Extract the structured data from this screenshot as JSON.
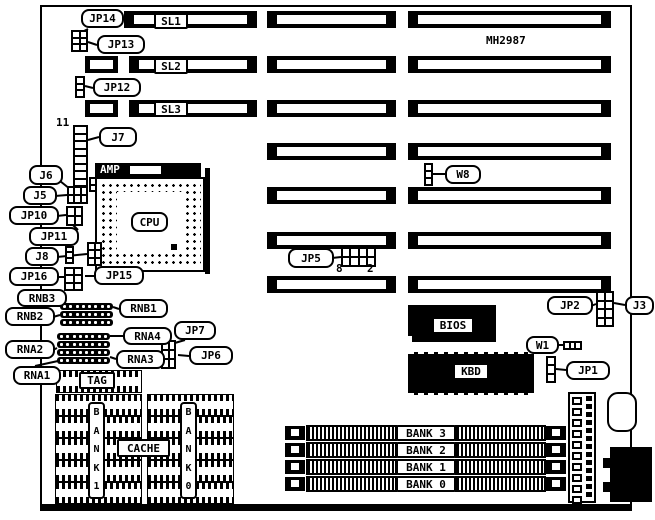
{
  "diagram_title": "MH2987",
  "board": {
    "part_number": "MH2987"
  },
  "cpu": {
    "socket_brand": "AMP",
    "chip_label": "CPU"
  },
  "texts": [
    {
      "name": "board-part-number",
      "text": "MH2987",
      "x": 486,
      "y": 34
    },
    {
      "name": "j7-pin-11",
      "text": "11",
      "x": 56,
      "y": 116
    },
    {
      "name": "jp5-pin-8",
      "text": "8",
      "x": 336,
      "y": 262
    },
    {
      "name": "jp5-pin-2",
      "text": "2",
      "x": 367,
      "y": 262
    }
  ],
  "callouts": [
    {
      "name": "label-jp14",
      "text": "JP14",
      "x": 81,
      "y": 9,
      "w": 43,
      "h": 19,
      "kind": "round"
    },
    {
      "name": "label-sl1",
      "text": "SL1",
      "x": 154,
      "y": 13,
      "w": 34,
      "h": 16,
      "kind": "square"
    },
    {
      "name": "label-jp13",
      "text": "JP13",
      "x": 97,
      "y": 35,
      "w": 48,
      "h": 19,
      "kind": "round"
    },
    {
      "name": "label-sl2",
      "text": "SL2",
      "x": 154,
      "y": 58,
      "w": 34,
      "h": 16,
      "kind": "square"
    },
    {
      "name": "label-jp12",
      "text": "JP12",
      "x": 93,
      "y": 78,
      "w": 48,
      "h": 19,
      "kind": "round"
    },
    {
      "name": "label-sl3",
      "text": "SL3",
      "x": 154,
      "y": 101,
      "w": 34,
      "h": 16,
      "kind": "square"
    },
    {
      "name": "label-j7",
      "text": "J7",
      "x": 99,
      "y": 127,
      "w": 38,
      "h": 20,
      "kind": "round"
    },
    {
      "name": "label-j6",
      "text": "J6",
      "x": 29,
      "y": 165,
      "w": 34,
      "h": 20,
      "kind": "round"
    },
    {
      "name": "label-j5",
      "text": "J5",
      "x": 23,
      "y": 186,
      "w": 34,
      "h": 19,
      "kind": "round"
    },
    {
      "name": "label-jp10",
      "text": "JP10",
      "x": 9,
      "y": 206,
      "w": 50,
      "h": 19,
      "kind": "round"
    },
    {
      "name": "label-jp11",
      "text": "JP11",
      "x": 29,
      "y": 227,
      "w": 50,
      "h": 19,
      "kind": "round"
    },
    {
      "name": "label-j8",
      "text": "J8",
      "x": 25,
      "y": 247,
      "w": 34,
      "h": 19,
      "kind": "round"
    },
    {
      "name": "label-jp16",
      "text": "JP16",
      "x": 9,
      "y": 267,
      "w": 50,
      "h": 19,
      "kind": "round"
    },
    {
      "name": "label-jp15",
      "text": "JP15",
      "x": 94,
      "y": 266,
      "w": 50,
      "h": 19,
      "kind": "round"
    },
    {
      "name": "label-rnb3",
      "text": "RNB3",
      "x": 17,
      "y": 289,
      "w": 50,
      "h": 18,
      "kind": "round"
    },
    {
      "name": "label-rnb1",
      "text": "RNB1",
      "x": 119,
      "y": 299,
      "w": 49,
      "h": 19,
      "kind": "round"
    },
    {
      "name": "label-rnb2",
      "text": "RNB2",
      "x": 5,
      "y": 307,
      "w": 50,
      "h": 19,
      "kind": "round"
    },
    {
      "name": "label-rna4",
      "text": "RNA4",
      "x": 123,
      "y": 327,
      "w": 49,
      "h": 18,
      "kind": "round"
    },
    {
      "name": "label-jp7",
      "text": "JP7",
      "x": 174,
      "y": 321,
      "w": 42,
      "h": 19,
      "kind": "round"
    },
    {
      "name": "label-rna2",
      "text": "RNA2",
      "x": 5,
      "y": 340,
      "w": 50,
      "h": 19,
      "kind": "round"
    },
    {
      "name": "label-rna3",
      "text": "RNA3",
      "x": 116,
      "y": 350,
      "w": 49,
      "h": 19,
      "kind": "round"
    },
    {
      "name": "label-jp6",
      "text": "JP6",
      "x": 189,
      "y": 346,
      "w": 44,
      "h": 19,
      "kind": "round"
    },
    {
      "name": "label-rna1",
      "text": "RNA1",
      "x": 13,
      "y": 366,
      "w": 48,
      "h": 19,
      "kind": "round"
    },
    {
      "name": "label-tag",
      "text": "TAG",
      "x": 79,
      "y": 372,
      "w": 36,
      "h": 17,
      "kind": "square"
    },
    {
      "name": "label-cpu",
      "text": "CPU",
      "x": 131,
      "y": 212,
      "w": 37,
      "h": 20,
      "kind": "round"
    },
    {
      "name": "label-cache",
      "text": "CACHE",
      "x": 117,
      "y": 439,
      "w": 53,
      "h": 18,
      "kind": "square"
    },
    {
      "name": "label-jp5",
      "text": "JP5",
      "x": 288,
      "y": 248,
      "w": 46,
      "h": 20,
      "kind": "round"
    },
    {
      "name": "label-w8",
      "text": "W8",
      "x": 445,
      "y": 165,
      "w": 36,
      "h": 19,
      "kind": "round"
    },
    {
      "name": "label-bios",
      "text": "BIOS",
      "x": 432,
      "y": 317,
      "w": 42,
      "h": 17,
      "kind": "square"
    },
    {
      "name": "label-kbd",
      "text": "KBD",
      "x": 453,
      "y": 363,
      "w": 36,
      "h": 17,
      "kind": "square"
    },
    {
      "name": "label-jp2",
      "text": "JP2",
      "x": 547,
      "y": 296,
      "w": 46,
      "h": 19,
      "kind": "round"
    },
    {
      "name": "label-j3",
      "text": "J3",
      "x": 625,
      "y": 296,
      "w": 29,
      "h": 19,
      "kind": "round"
    },
    {
      "name": "label-w1",
      "text": "W1",
      "x": 526,
      "y": 336,
      "w": 33,
      "h": 18,
      "kind": "round"
    },
    {
      "name": "label-jp1",
      "text": "JP1",
      "x": 566,
      "y": 361,
      "w": 44,
      "h": 19,
      "kind": "round"
    },
    {
      "name": "label-simm-bank3",
      "text": "BANK 3",
      "x": 396,
      "y": 425,
      "w": 60,
      "h": 16,
      "kind": "square"
    },
    {
      "name": "label-simm-bank2",
      "text": "BANK 2",
      "x": 396,
      "y": 442,
      "w": 60,
      "h": 16,
      "kind": "square"
    },
    {
      "name": "label-simm-bank1",
      "text": "BANK 1",
      "x": 396,
      "y": 459,
      "w": 60,
      "h": 16,
      "kind": "square"
    },
    {
      "name": "label-simm-bank0",
      "text": "BANK 0",
      "x": 396,
      "y": 476,
      "w": 60,
      "h": 16,
      "kind": "square"
    }
  ],
  "vertical_labels": [
    {
      "name": "label-cache-bank1",
      "text": "BANK1",
      "x": 88,
      "y": 402,
      "w": 17,
      "h": 97
    },
    {
      "name": "label-cache-bank0",
      "text": "BANK0",
      "x": 180,
      "y": 402,
      "w": 17,
      "h": 97
    }
  ],
  "slot_rows": [
    {
      "y": 11,
      "h": 17,
      "segments": [
        {
          "x": 124,
          "w": 133
        },
        {
          "x": 267,
          "w": 129
        },
        {
          "x": 408,
          "w": 203
        }
      ]
    },
    {
      "y": 56,
      "h": 17,
      "segments": [
        {
          "x": 85,
          "w": 33,
          "narrow": true
        },
        {
          "x": 129,
          "w": 128
        },
        {
          "x": 267,
          "w": 129
        },
        {
          "x": 408,
          "w": 203
        }
      ]
    },
    {
      "y": 100,
      "h": 17,
      "segments": [
        {
          "x": 85,
          "w": 33,
          "narrow": true
        },
        {
          "x": 129,
          "w": 128
        },
        {
          "x": 267,
          "w": 129
        },
        {
          "x": 408,
          "w": 203
        }
      ]
    },
    {
      "y": 143,
      "h": 17,
      "segments": [
        {
          "x": 267,
          "w": 129
        },
        {
          "x": 408,
          "w": 203
        }
      ]
    },
    {
      "y": 187,
      "h": 17,
      "segments": [
        {
          "x": 267,
          "w": 129
        },
        {
          "x": 408,
          "w": 203
        }
      ]
    },
    {
      "y": 232,
      "h": 17,
      "segments": [
        {
          "x": 267,
          "w": 129
        },
        {
          "x": 408,
          "w": 203
        }
      ]
    },
    {
      "y": 276,
      "h": 17,
      "segments": [
        {
          "x": 267,
          "w": 129
        },
        {
          "x": 408,
          "w": 203
        }
      ]
    }
  ],
  "jumpers": [
    {
      "name": "jp13-jp14-block",
      "x": 71,
      "y": 30,
      "w": 17,
      "h": 22,
      "cols": 2,
      "rows": 3
    },
    {
      "name": "jp12-block",
      "x": 75,
      "y": 76,
      "w": 10,
      "h": 22,
      "cols": 1,
      "rows": 3
    },
    {
      "name": "j7-header",
      "x": 73,
      "y": 125,
      "w": 15,
      "h": 62,
      "cols": 1,
      "rows": 8
    },
    {
      "name": "j5-j6-block",
      "x": 67,
      "y": 186,
      "w": 21,
      "h": 18,
      "cols": 3,
      "rows": 2
    },
    {
      "name": "jp10-block",
      "x": 66,
      "y": 206,
      "w": 17,
      "h": 20,
      "cols": 2,
      "rows": 2
    },
    {
      "name": "j8-block",
      "x": 65,
      "y": 246,
      "w": 9,
      "h": 18,
      "cols": 1,
      "rows": 3
    },
    {
      "name": "jp16-block",
      "x": 64,
      "y": 267,
      "w": 19,
      "h": 24,
      "cols": 2,
      "rows": 3
    },
    {
      "name": "socket-tab-upper",
      "x": 89,
      "y": 177,
      "w": 8,
      "h": 15,
      "cols": 1,
      "rows": 2
    },
    {
      "name": "socket-tab-lower",
      "x": 87,
      "y": 242,
      "w": 15,
      "h": 24,
      "cols": 2,
      "rows": 3
    },
    {
      "name": "jp6-jp7-block",
      "x": 161,
      "y": 340,
      "w": 15,
      "h": 29,
      "cols": 2,
      "rows": 3
    },
    {
      "name": "jp5-block",
      "x": 341,
      "y": 247,
      "w": 35,
      "h": 20,
      "cols": 4,
      "rows": 2
    },
    {
      "name": "w8-block",
      "x": 424,
      "y": 163,
      "w": 9,
      "h": 23,
      "cols": 1,
      "rows": 3
    },
    {
      "name": "jp2-j3-block",
      "x": 596,
      "y": 291,
      "w": 18,
      "h": 36,
      "cols": 2,
      "rows": 4
    },
    {
      "name": "w1-block",
      "x": 563,
      "y": 341,
      "w": 19,
      "h": 9,
      "cols": 3,
      "rows": 1
    },
    {
      "name": "jp1-block",
      "x": 546,
      "y": 356,
      "w": 10,
      "h": 27,
      "cols": 1,
      "rows": 3
    }
  ],
  "resistor_networks": [
    {
      "name": "rnb-bar-1",
      "x": 60,
      "y": 303,
      "w": 53,
      "h": 7,
      "dots": 8
    },
    {
      "name": "rnb-bar-2",
      "x": 60,
      "y": 311,
      "w": 53,
      "h": 7,
      "dots": 8
    },
    {
      "name": "rnb-bar-3",
      "x": 60,
      "y": 319,
      "w": 53,
      "h": 7,
      "dots": 8
    },
    {
      "name": "rna-bar-1",
      "x": 57,
      "y": 333,
      "w": 53,
      "h": 7,
      "dots": 8
    },
    {
      "name": "rna-bar-2",
      "x": 57,
      "y": 341,
      "w": 53,
      "h": 7,
      "dots": 8
    },
    {
      "name": "rna-bar-3",
      "x": 57,
      "y": 349,
      "w": 53,
      "h": 7,
      "dots": 8
    },
    {
      "name": "rna-bar-4",
      "x": 57,
      "y": 357,
      "w": 53,
      "h": 7,
      "dots": 8
    }
  ],
  "dip_chips": [
    {
      "name": "tag-ram-chip",
      "x": 56,
      "y": 370,
      "w": 84,
      "h": 21
    },
    {
      "name": "cache-chip",
      "x": 55,
      "y": 394,
      "w": 85,
      "h": 20
    },
    {
      "name": "cache-chip",
      "x": 55,
      "y": 416,
      "w": 40,
      "h": 20
    },
    {
      "name": "cache-chip",
      "x": 100,
      "y": 416,
      "w": 40,
      "h": 20
    },
    {
      "name": "cache-chip",
      "x": 55,
      "y": 438,
      "w": 40,
      "h": 20
    },
    {
      "name": "cache-chip",
      "x": 100,
      "y": 438,
      "w": 40,
      "h": 20
    },
    {
      "name": "cache-chip",
      "x": 55,
      "y": 460,
      "w": 40,
      "h": 20
    },
    {
      "name": "cache-chip",
      "x": 100,
      "y": 460,
      "w": 40,
      "h": 20
    },
    {
      "name": "cache-chip",
      "x": 55,
      "y": 482,
      "w": 85,
      "h": 20
    },
    {
      "name": "cache-chip",
      "x": 147,
      "y": 394,
      "w": 85,
      "h": 20
    },
    {
      "name": "cache-chip",
      "x": 147,
      "y": 416,
      "w": 40,
      "h": 20
    },
    {
      "name": "cache-chip",
      "x": 192,
      "y": 416,
      "w": 40,
      "h": 20
    },
    {
      "name": "cache-chip",
      "x": 147,
      "y": 438,
      "w": 40,
      "h": 20
    },
    {
      "name": "cache-chip",
      "x": 192,
      "y": 438,
      "w": 40,
      "h": 20
    },
    {
      "name": "cache-chip",
      "x": 147,
      "y": 460,
      "w": 40,
      "h": 20
    },
    {
      "name": "cache-chip",
      "x": 192,
      "y": 460,
      "w": 40,
      "h": 20
    },
    {
      "name": "cache-chip",
      "x": 147,
      "y": 482,
      "w": 85,
      "h": 20
    }
  ],
  "simm_rows": [
    {
      "name": "simm-socket-bank3",
      "y": 425
    },
    {
      "name": "simm-socket-bank2",
      "y": 442
    },
    {
      "name": "simm-socket-bank1",
      "y": 459
    },
    {
      "name": "simm-socket-bank0",
      "y": 476
    }
  ],
  "callout_lines": [
    [
      88,
      29,
      78,
      34
    ],
    [
      97,
      45,
      88,
      42
    ],
    [
      93,
      88,
      85,
      86
    ],
    [
      99,
      137,
      88,
      140
    ],
    [
      60,
      181,
      70,
      189
    ],
    [
      55,
      196,
      67,
      195
    ],
    [
      57,
      216,
      66,
      215
    ],
    [
      78,
      230,
      72,
      224
    ],
    [
      57,
      257,
      87,
      254
    ],
    [
      57,
      277,
      64,
      277
    ],
    [
      94,
      276,
      85,
      276
    ],
    [
      42,
      306,
      62,
      306
    ],
    [
      119,
      309,
      113,
      307
    ],
    [
      53,
      317,
      60,
      315
    ],
    [
      123,
      336,
      110,
      336
    ],
    [
      185,
      340,
      168,
      345
    ],
    [
      53,
      350,
      57,
      348
    ],
    [
      116,
      359,
      110,
      357
    ],
    [
      189,
      356,
      178,
      355
    ],
    [
      35,
      366,
      58,
      361
    ],
    [
      332,
      258,
      341,
      257
    ],
    [
      445,
      174,
      433,
      174
    ],
    [
      591,
      306,
      596,
      304
    ],
    [
      625,
      305,
      614,
      303
    ],
    [
      557,
      345,
      563,
      345
    ],
    [
      566,
      370,
      556,
      369
    ]
  ]
}
